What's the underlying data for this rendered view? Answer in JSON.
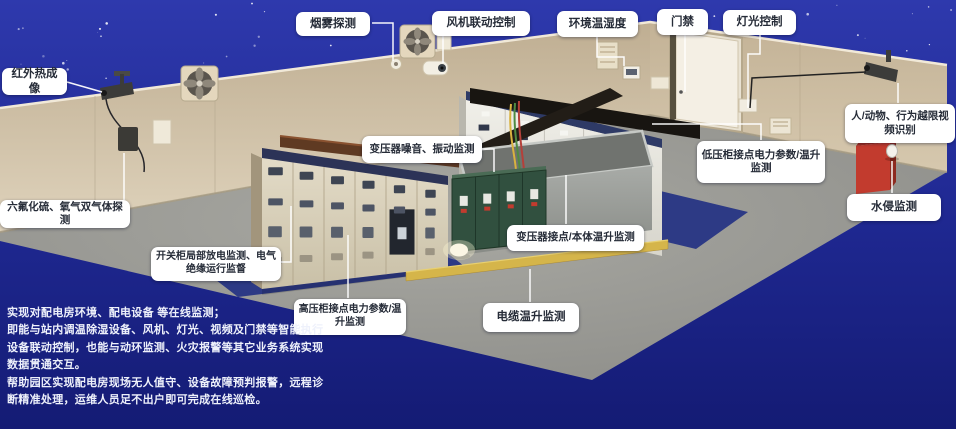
{
  "callouts": {
    "smoke": {
      "label": "烟雾探测"
    },
    "fan_control": {
      "label": "风机联动控制"
    },
    "env_temp_humidity": {
      "label": "环境温湿度"
    },
    "door_access": {
      "label": "门禁"
    },
    "light_control": {
      "label": "灯光控制"
    },
    "infrared_thermal": {
      "label": "红外热成像"
    },
    "gas_detection": {
      "label": "六氟化硫、氧气双气体探测"
    },
    "partial_discharge": {
      "label": "开关柜局部放电监测、电气绝缘运行监督"
    },
    "hv_cabinet": {
      "label": "高压柜接点电力参数/温升监测"
    },
    "transformer_noise": {
      "label": "变压器噪音、振动监测"
    },
    "transformer_contact": {
      "label": "变压器接点/本体温升监测"
    },
    "cable_temp": {
      "label": "电缆温升监测"
    },
    "lv_cabinet": {
      "label": "低压柜接点电力参数/温升监测"
    },
    "video_recognition": {
      "label": "人/动物、行为越限视频识别"
    },
    "water_intrusion": {
      "label": "水侵监测"
    }
  },
  "description": {
    "lines": [
      "实现对配电房环境、配电设备 等在线监测；",
      "即能与站内调温除湿设备、风机、灯光、视频及门禁等智能执行",
      "设备联动控制，也能与动环监测、火灾报警等其它业务系统实现",
      "数据贯通交互。",
      "帮助园区实现配电房现场无人值守、设备故障预判报警，远程诊",
      "断精准处理，运维人员足不出户即可完成在线巡检。"
    ]
  },
  "colors": {
    "sky_blue": "#2e39ad",
    "deep_blue": "#141b74",
    "wall_beige": "#d2c3aa",
    "floor_gray": "#9a9a96",
    "platform_navy": "#2d3a85",
    "callout_bg": "#ffffff",
    "callout_text": "#262c38",
    "alarm_red": "#c23b2e",
    "trench_yellow": "#d5b54a"
  }
}
